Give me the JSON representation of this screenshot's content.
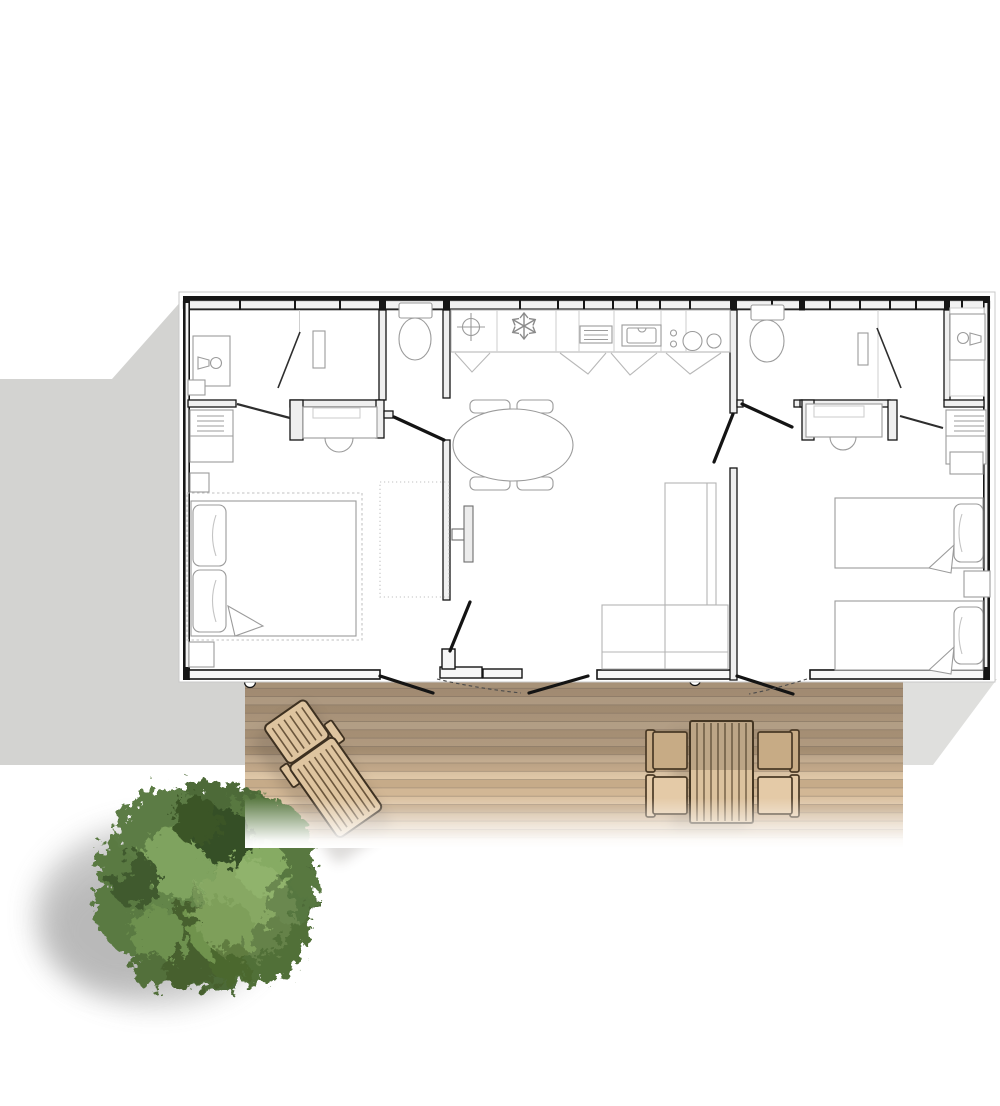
{
  "scene": {
    "type": "architectural-floor-plan-top-view",
    "description": "Top view plan of a two-bedroom holiday home with central kitchen-living room, two shower/WC zones, a wooden terrace with sun lounger and dining set, and a round tree",
    "rooms": [
      "bathroom-left",
      "wc-left",
      "double-bedroom",
      "kitchen-living-room",
      "wc-right",
      "shower-room-right",
      "twin-bedroom",
      "wooden-terrace"
    ],
    "furniture": [
      "washbasin-left",
      "toilet-left",
      "vanity-left",
      "dresser-left",
      "double-bed",
      "nightstands",
      "wardrobe-zone-dotted",
      "kitchen-counter",
      "fridge-snowflake",
      "kitchen-sink",
      "hob-4-rings",
      "oval-dining-table",
      "dining-chairs",
      "wall-tv",
      "corner-sofa",
      "toilet-right",
      "closet-right",
      "washbasin-right",
      "vanity-right",
      "dresser-right",
      "twin-bed-1",
      "twin-bed-2",
      "sun-lounger",
      "outdoor-table",
      "outdoor-chairs",
      "tree"
    ]
  },
  "colors": {
    "wall": "#161616",
    "wall_fill": "#f1f1f1",
    "fixture": "#9b9b9b",
    "shadow_left": "#d3d3d1",
    "shadow_right": "#dfdfdd",
    "deck_gap": "#a8937c",
    "lounger_wood": "#dec49f",
    "wood_outline": "#463723",
    "table_wood": "#dcc29e",
    "chair_shaded": "#c7ab85",
    "chair_light": "#e4caa7",
    "foliage_base": "#4d6a39",
    "foliage_light": "#7fa35e",
    "foliage_dark": "#364f27",
    "slat_line": "#5d4a33"
  },
  "deck": {
    "planks": [
      "#d3b896",
      "#c9ad8c",
      "#dac1a1",
      "#c4a987",
      "#d0b594",
      "#dcc4a4",
      "#c8ad8b",
      "#d5ba99",
      "#c1a684",
      "#d8bf9f",
      "#ccb190",
      "#dfc7a7",
      "#c6ab89",
      "#d2b795",
      "#dbc2a2",
      "#c3a886",
      "#cfb493",
      "#d7bd9d",
      "#cab08e",
      "#d4b997"
    ]
  }
}
